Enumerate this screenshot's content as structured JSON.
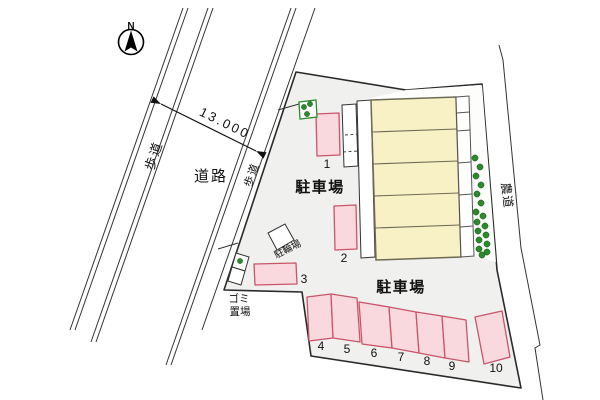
{
  "north": {
    "label": "N"
  },
  "dimension": {
    "road_width_label": "13.000"
  },
  "roads": {
    "sidewalk_left_label": "歩道",
    "sidewalk_right_label": "歩道",
    "road_label": "道路",
    "farm_road_label": "農道"
  },
  "site": {
    "parking_lot_upper_label": "駐車場",
    "parking_lot_lower_label": "駐車場",
    "bicycle_parking_label": "駐輪場",
    "garbage_area_label_line1": "ゴミ",
    "garbage_area_label_line2": "置場",
    "building_units": 5,
    "space_labels": [
      "1",
      "2",
      "3",
      "4",
      "5",
      "6",
      "7",
      "8",
      "9",
      "10"
    ]
  },
  "colors": {
    "site_fill": "#f0f0ee",
    "boundary": "#2a2a2a",
    "parking_space_fill": "#f9d9de",
    "parking_space_border": "#c9556a",
    "building_fill": "#f8f1c6",
    "building_border": "#6d6a54",
    "greenery": "#2c8a2c",
    "road_line": "#333333"
  }
}
